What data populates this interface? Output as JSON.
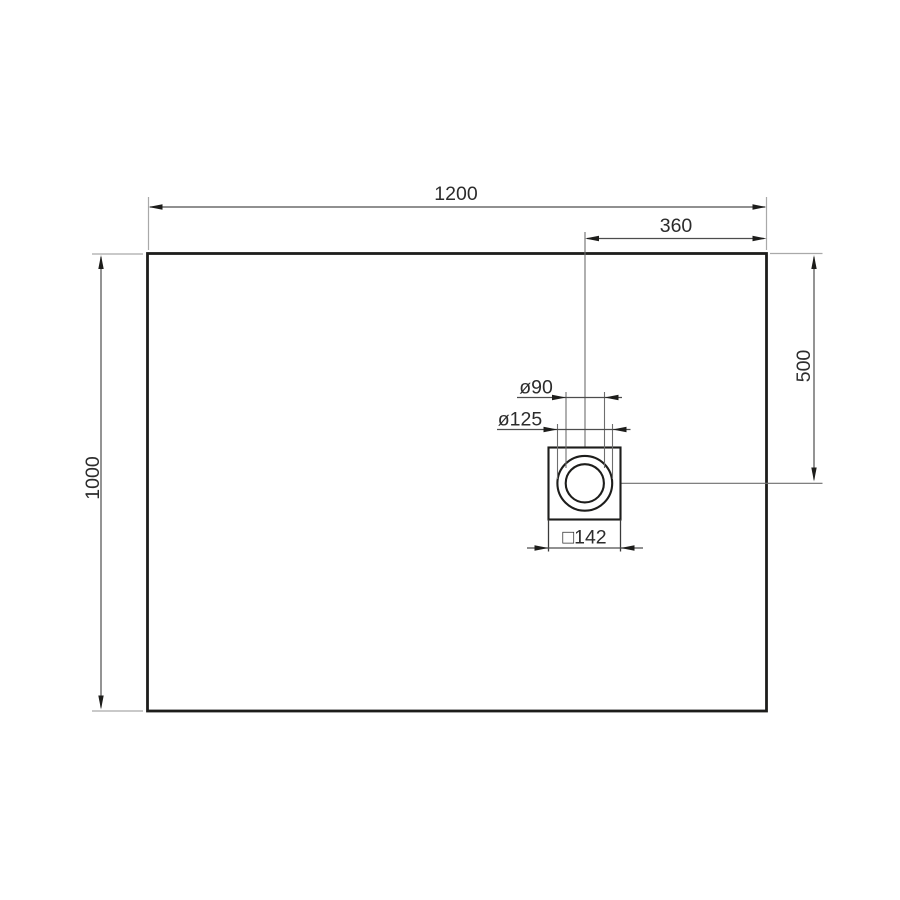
{
  "diagram": {
    "labels": {
      "overall_width": "1200",
      "drain_offset_from_right": "360",
      "overall_depth": "1000",
      "drain_offset_from_top": "500",
      "drain_inner_diameter": "ø90",
      "drain_outer_diameter": "ø125",
      "drain_square_size": "□142"
    },
    "colors": {
      "background": "#ffffff",
      "outline": "#1d1d1b",
      "dimension_line": "#4d4d4d",
      "extension_line": "#a9a9a9",
      "centerline": "#6e6e6e",
      "text": "#2c2c2c"
    }
  }
}
